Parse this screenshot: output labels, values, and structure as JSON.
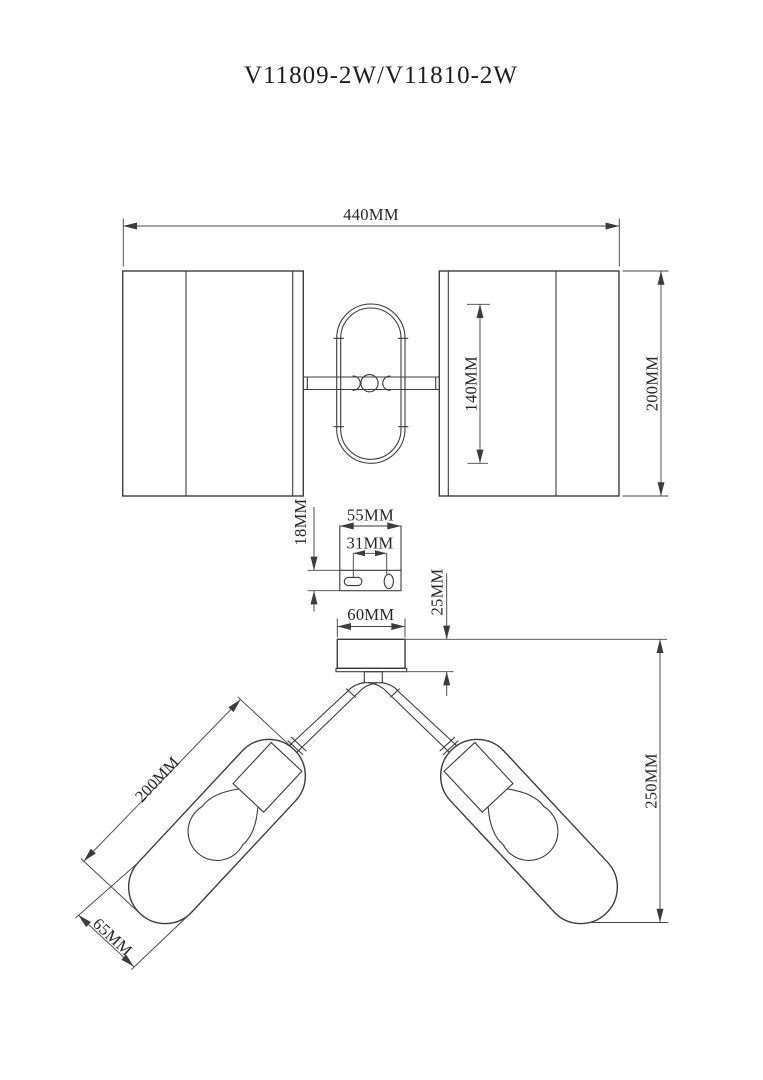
{
  "title": "V11809-2W/V11810-2W",
  "colors": {
    "line": "#3c3c3c",
    "dimension": "#474747",
    "text": "#262626",
    "background": "#ffffff"
  },
  "front_view": {
    "overall_width": "440MM",
    "shade_height": "200MM",
    "frame_height": "140MM"
  },
  "bracket_view": {
    "plate_width": "55MM",
    "hole_spacing": "31MM",
    "flange_height": "18MM"
  },
  "side_view": {
    "canopy_diameter": "60MM",
    "canopy_height": "25MM",
    "overall_drop": "250MM",
    "shade_length": "200MM",
    "shade_diameter": "65MM"
  }
}
